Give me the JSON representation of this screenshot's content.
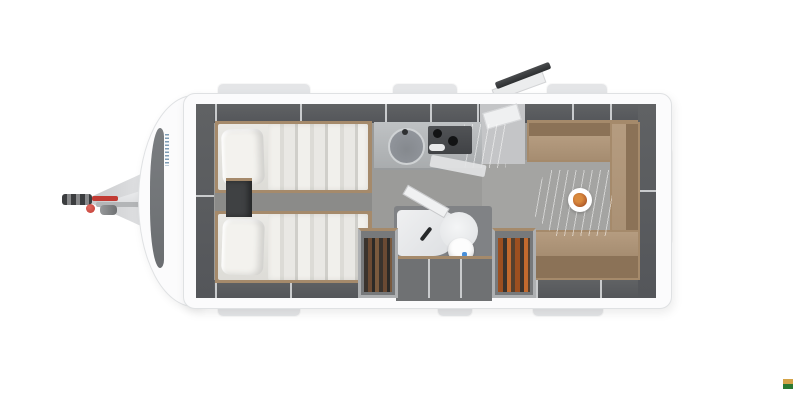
{
  "scene": {
    "type": "caravan floor plan - top-down 3D render",
    "canvas_width": 800,
    "canvas_height": 400,
    "zones": [
      "hitch-drawbar",
      "front-cap",
      "twin-bed-top",
      "twin-bed-bottom",
      "nightstand",
      "kitchen-block",
      "entrance-door-open",
      "dinette-u-bench",
      "dining-table",
      "plate-of-food",
      "bathroom-shower",
      "toilet",
      "wardrobe-left",
      "wardrobe-right",
      "overhead-lockers",
      "window-bumps",
      "watermark-mark"
    ]
  },
  "colors": {
    "page_bg": "#ffffff",
    "body": "#fbfbfc",
    "body_border": "#dfe1e3",
    "bump": "#e4e5e7",
    "wall": "#606264",
    "wall_deep": "#54565a",
    "wall_divider": "#c9cbcd",
    "floor": "#9b9b99",
    "floor_dark": "#8b8b89",
    "dinette_floor": "#a4a4a2",
    "entry_floor": "#c4c5c7",
    "wood": "#a58a6b",
    "mattress": "#eae9e5",
    "pillow": "#f3f2ee",
    "bench": "#b59c80",
    "bench_dark": "#8b7257",
    "counter": "#bfc2c4",
    "cooktop": "#404245",
    "sink": "#9599a0",
    "red": "#c23b34",
    "hitch_dark": "#3b3d3f",
    "hitch_gray": "#b3b5b7",
    "front_window": "#6b6e71",
    "brand_blue": "#7e9cb5",
    "door_dark": "#2d2f31",
    "bath_wall": "#808285",
    "shower": "#eff0f1",
    "plate": "#ffffff",
    "food": "#bf6a31",
    "wm_gold": "#d4a348",
    "wm_green": "#2b7a33"
  },
  "watermark": {
    "top_color": "#d4a348",
    "bottom_color": "#2b7a33"
  }
}
